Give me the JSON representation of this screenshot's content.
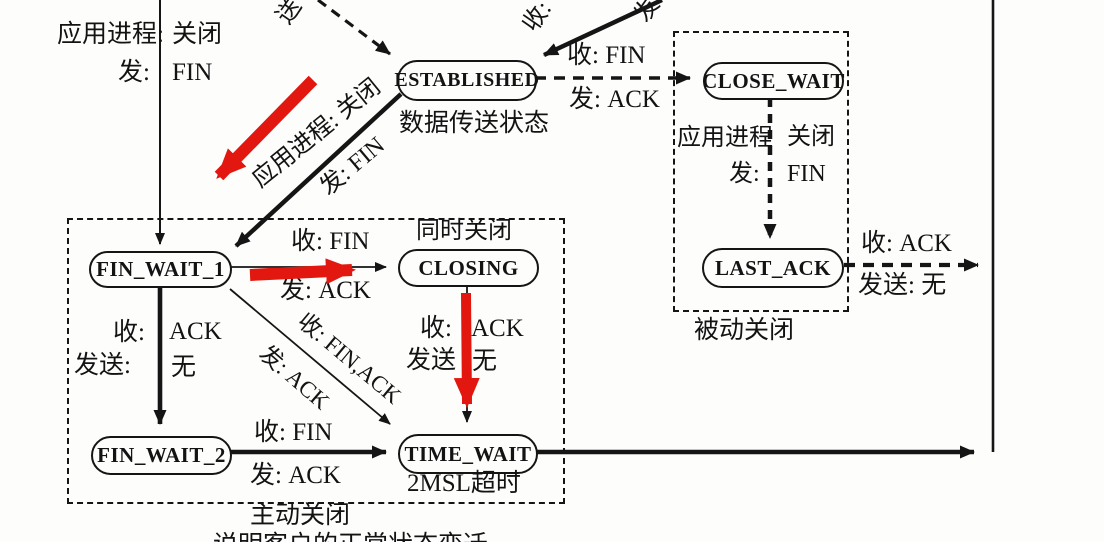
{
  "diagram": {
    "states": {
      "established": "ESTABLISHED",
      "close_wait": "CLOSE_WAIT",
      "fin_wait_1": "FIN_WAIT_1",
      "closing": "CLOSING",
      "last_ack": "LAST_ACK",
      "fin_wait_2": "FIN_WAIT_2",
      "time_wait": "TIME_WAIT"
    },
    "notes": {
      "established": "数据传送状态",
      "closing": "同时关闭",
      "time_wait": "2MSL超时",
      "active_close": "主动关闭",
      "passive_close": "被动关闭",
      "caption": "说明客户的正常状态变迁"
    },
    "transitions": {
      "app_close_recv_label": "应用进程:",
      "app_close_recv_value": "关闭",
      "app_close_send_label": "发:",
      "app_close_send_value": "FIN",
      "est_to_close_wait_recv": "收: FIN",
      "est_to_close_wait_send": "发: ACK",
      "est_to_fw1_line1": "应用进程: 关闭",
      "est_to_fw1_line2": "发: FIN",
      "edge_cut_recv": "收:",
      "edge_cut_send": "发",
      "edge_cut_song": "送",
      "fw1_to_closing_recv": "收: FIN",
      "fw1_to_closing_send": "发: ACK",
      "fw1_to_fw2_recv_label": "收:",
      "fw1_to_fw2_recv_value": "ACK",
      "fw1_to_fw2_send_label": "发送:",
      "fw1_to_fw2_send_value": "无",
      "fw1_to_tw_recv": "收: FIN,ACK",
      "fw1_to_tw_send": "发: ACK",
      "closing_to_tw_recv_label": "收:",
      "closing_to_tw_recv_value": "ACK",
      "closing_to_tw_send_label": "发送",
      "closing_to_tw_send_value": "无",
      "fw2_to_tw_recv": "收: FIN",
      "fw2_to_tw_send": "发: ACK",
      "cw_app_label": "应用进程",
      "cw_app_value": "关闭",
      "cw_send_label": "发:",
      "cw_send_value": "FIN",
      "la_recv": "收: ACK",
      "la_send": "发送: 无"
    }
  }
}
